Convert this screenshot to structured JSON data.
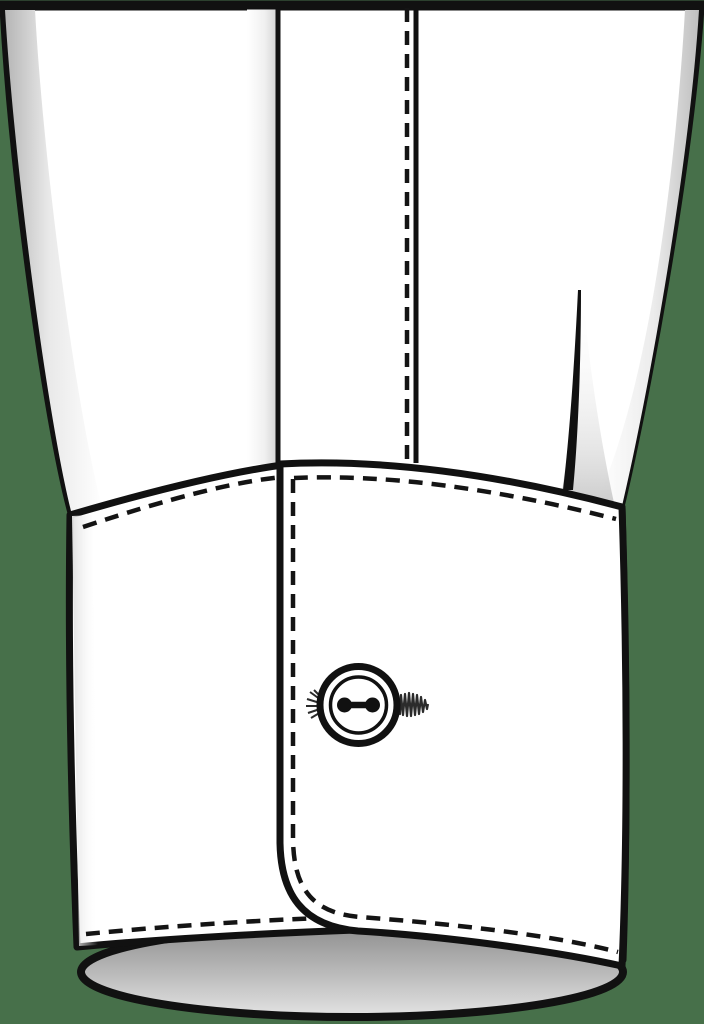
{
  "illustration": {
    "subject": "Technical flat drawing of a dress-shirt sleeve barrel cuff with button and thread shank",
    "parts": [
      "sleeve",
      "placket-fold",
      "placket-topstitching",
      "sleeve-pleat",
      "cuff-under-piece",
      "cuff-over-piece-rounded-corner",
      "cuff-topstitching",
      "cuff-button",
      "button-thread-shank",
      "cuff-opening"
    ]
  },
  "colors": {
    "background": "#47704a",
    "outline": "#111111",
    "fabric": "#ffffff",
    "stitch": "#141414",
    "shade_strong": "#b5b5b5",
    "shade_soft": "#e9e9e9",
    "opening_top": "#8f8f8f",
    "opening_bottom": "#e4e4e4"
  }
}
